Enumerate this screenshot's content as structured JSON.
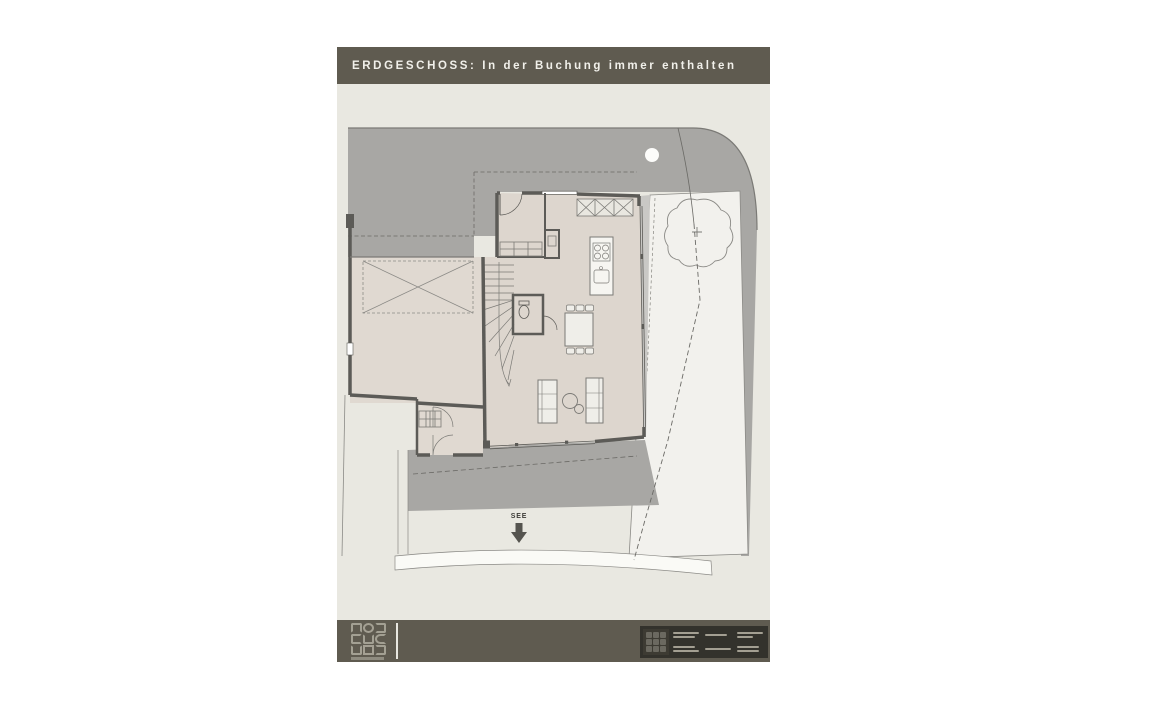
{
  "page": {
    "title": "ERDGESCHOSS: In der Buchung immer enthalten"
  },
  "plan": {
    "see_label": "SEE",
    "see_arrow_icon": "down-arrow",
    "tree_icon": "tree-crown",
    "parking_icon": "crossed-parking-box",
    "survey_point_icon": "white-circle"
  },
  "footer": {
    "logo_icon": "grid-logo",
    "title_block_icon": "architect-stamp"
  },
  "palette": {
    "header_bar": "#5f5b50",
    "drawing_background": "#e9e8e1",
    "parcel_gray": "#a8a7a4",
    "room_floor": "#ddd6ce",
    "wall": "#5c5b57",
    "garden": "#f2f1ed",
    "terrace_gray": "#a8a7a4",
    "footer_bar": "#5f5b50",
    "title_block": "#33322c"
  }
}
